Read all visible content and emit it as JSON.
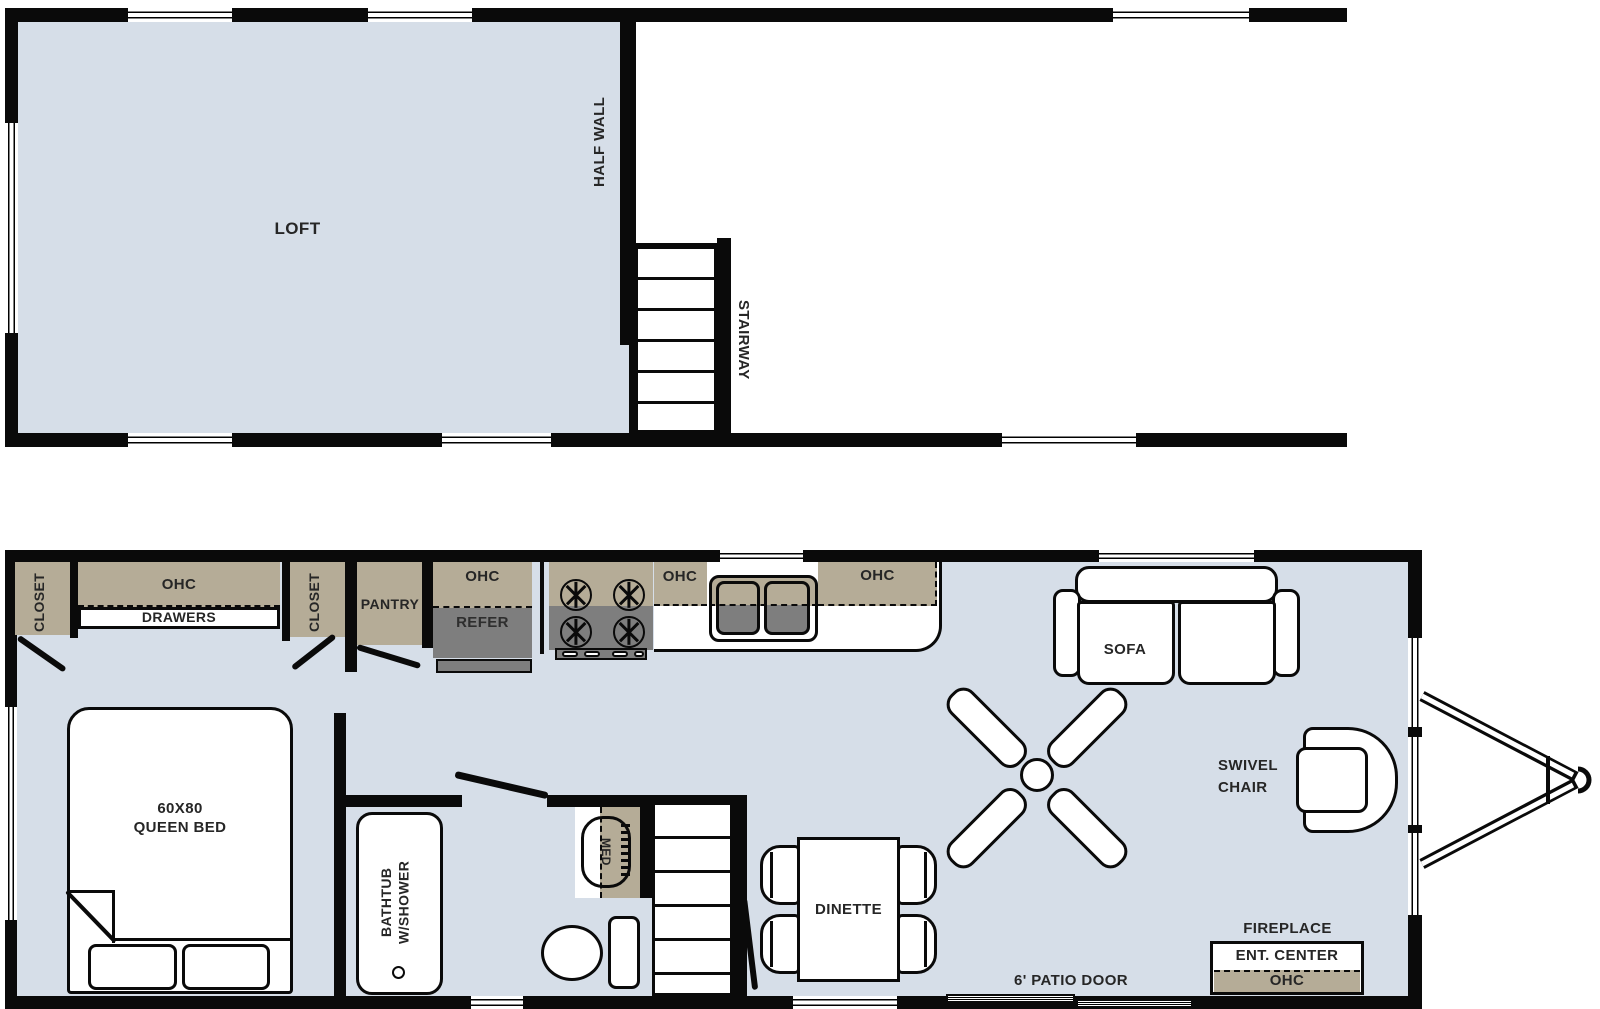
{
  "colors": {
    "floor": "#d6dee8",
    "cabinet_tan": "#b5ac97",
    "appliance_gray": "#7e7e7e",
    "wall_black": "#0a0a0a",
    "label_text": "#262626"
  },
  "upper_plan": {
    "labels": {
      "loft": "LOFT",
      "half_wall": "HALF WALL",
      "stairway": "STAIRWAY"
    }
  },
  "lower_plan": {
    "labels": {
      "closet_left": "CLOSET",
      "ohc_bedroom": "OHC",
      "drawers": "DRAWERS",
      "closet_right": "CLOSET",
      "pantry": "PANTRY",
      "ohc_refer": "OHC",
      "refer": "REFER",
      "ohc_mid": "OHC",
      "ohc_right": "OHC",
      "sofa": "SOFA",
      "swivel_chair": "SWIVEL\nCHAIR",
      "dinette": "DINETTE",
      "fireplace": "FIREPLACE",
      "ent_center": "ENT. CENTER",
      "ohc_ent": "OHC",
      "patio_door": "6' PATIO DOOR",
      "queen_bed": "60X80\nQUEEN BED",
      "bathtub": "BATHTUB\nW/SHOWER",
      "med": "MED"
    }
  }
}
